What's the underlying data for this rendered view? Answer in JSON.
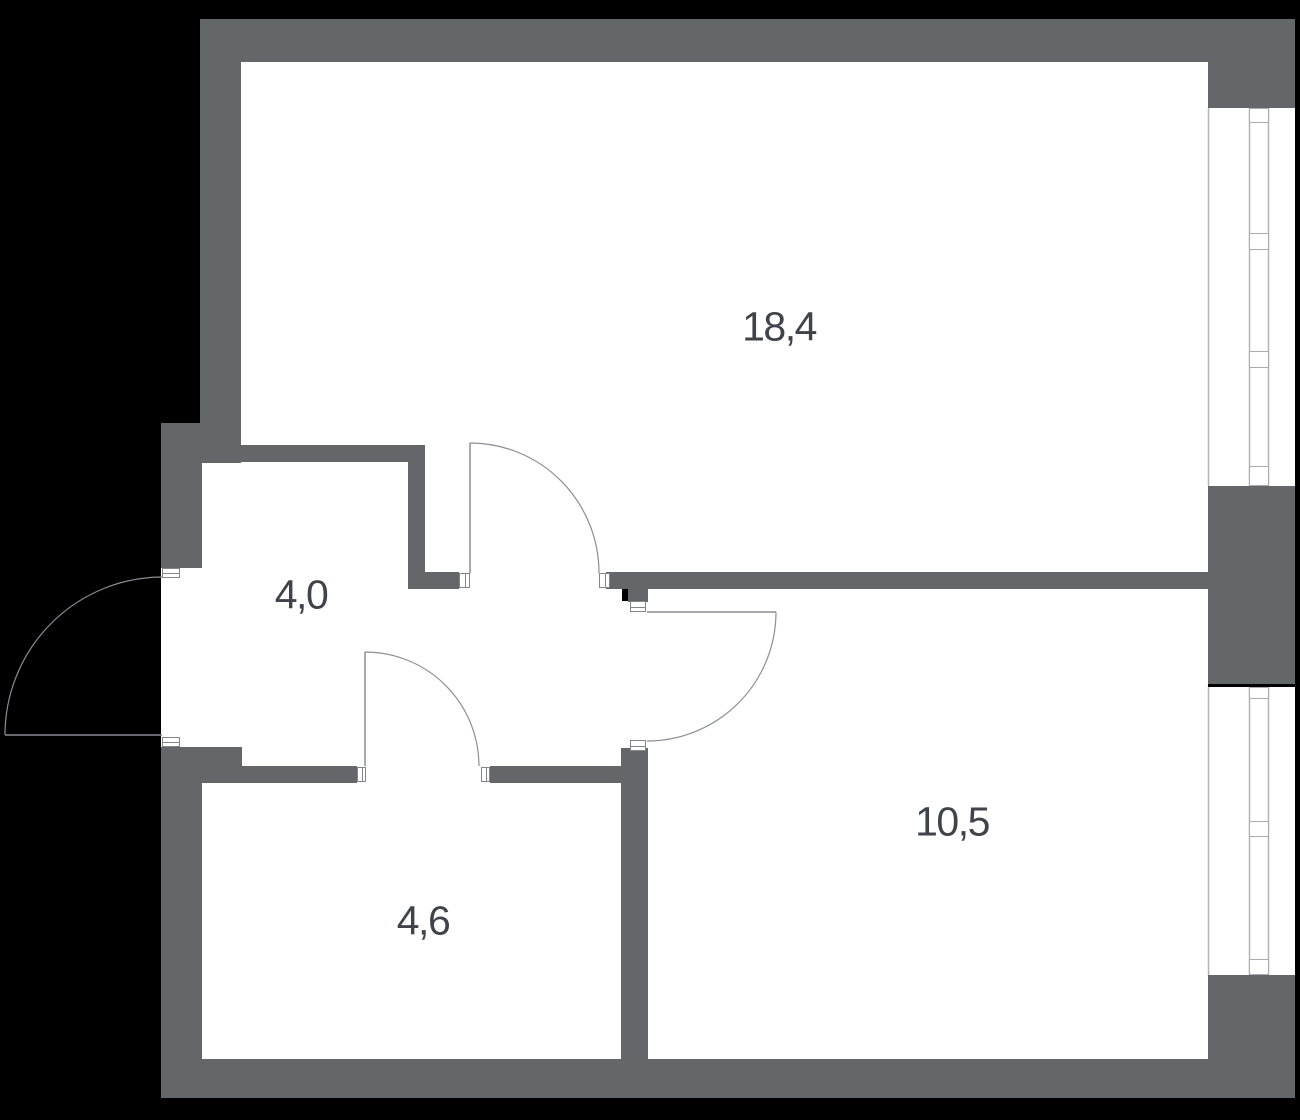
{
  "plan": {
    "background_color": "#000000",
    "floor_color": "#ffffff",
    "wall_color": "#64676a",
    "thin_line_color": "#8c8e96",
    "window_line_color": "#b2b4bd",
    "jamb_border_color": "#83858b",
    "label_color": "#3f444b",
    "rooms": [
      {
        "id": "room-18-4",
        "area": "18,4",
        "label_x": 779,
        "label_y": 327
      },
      {
        "id": "room-4-0",
        "area": "4,0",
        "label_x": 301,
        "label_y": 595
      },
      {
        "id": "room-4-6",
        "area": "4,6",
        "label_x": 423,
        "label_y": 921
      },
      {
        "id": "room-10-5",
        "area": "10,5",
        "label_x": 952,
        "label_y": 822
      }
    ],
    "floor_rects": [
      [
        241,
        62,
        967,
        511
      ],
      [
        200,
        463,
        208,
        303
      ],
      [
        408,
        589,
        214,
        177
      ],
      [
        459,
        573,
        151,
        16
      ],
      [
        622,
        601,
        26,
        152
      ],
      [
        357,
        766,
        133,
        17
      ],
      [
        161,
        568,
        41,
        179
      ],
      [
        202,
        783,
        420,
        276
      ],
      [
        648,
        589,
        560,
        470
      ],
      [
        1208,
        108,
        87,
        378
      ],
      [
        1208,
        687,
        87,
        288
      ]
    ],
    "walls": [
      [
        200,
        19,
        1095,
        43
      ],
      [
        1208,
        62,
        87,
        46
      ],
      [
        1208,
        486,
        87,
        198
      ],
      [
        1208,
        975,
        87,
        123
      ],
      [
        161,
        1059,
        1047,
        39
      ],
      [
        200,
        19,
        41,
        444
      ],
      [
        200,
        445,
        223,
        17
      ],
      [
        408,
        445,
        17,
        127
      ],
      [
        408,
        572,
        51,
        17
      ],
      [
        606,
        572,
        602,
        17
      ],
      [
        628,
        589,
        20,
        13
      ],
      [
        621,
        748,
        27,
        311
      ],
      [
        202,
        766,
        155,
        17
      ],
      [
        202,
        747,
        40,
        19
      ],
      [
        490,
        766,
        132,
        17
      ],
      [
        161,
        423,
        41,
        145
      ],
      [
        161,
        747,
        41,
        312
      ]
    ],
    "door_jambs": [
      {
        "x": 162,
        "y": 568,
        "w": 18,
        "h": 10,
        "o": "h"
      },
      {
        "x": 162,
        "y": 737,
        "w": 18,
        "h": 10,
        "o": "h"
      },
      {
        "x": 459,
        "y": 573,
        "w": 11,
        "h": 15,
        "o": "v"
      },
      {
        "x": 599,
        "y": 573,
        "w": 11,
        "h": 15,
        "o": "v"
      },
      {
        "x": 630,
        "y": 601,
        "w": 16,
        "h": 11,
        "o": "h"
      },
      {
        "x": 630,
        "y": 740,
        "w": 16,
        "h": 11,
        "o": "h"
      },
      {
        "x": 357,
        "y": 767,
        "w": 9,
        "h": 15,
        "o": "v"
      },
      {
        "x": 481,
        "y": 767,
        "w": 9,
        "h": 15,
        "o": "v"
      }
    ],
    "door_leaves": [
      [
        5,
        735,
        162,
        735
      ],
      [
        470,
        443,
        470,
        573
      ],
      [
        647,
        612,
        776,
        612
      ],
      [
        365,
        652,
        365,
        766
      ]
    ],
    "door_arcs": [
      "M 5 735 A 158 158 0 0 1 162 577",
      "M 470 443 A 129 130 0 0 1 599 573",
      "M 776 612 A 129 129 0 0 1 647 741",
      "M 365 652 A 114 114 0 0 1 479 766"
    ],
    "window_lines": [
      [
        1208.5,
        108,
        1208.5,
        486
      ],
      [
        1249.5,
        108,
        1249.5,
        486
      ],
      [
        1268.5,
        108,
        1268.5,
        486
      ],
      [
        1208.5,
        687,
        1208.5,
        975
      ],
      [
        1249.5,
        687,
        1249.5,
        975
      ],
      [
        1268.5,
        687,
        1268.5,
        975
      ]
    ],
    "window_transoms": [
      [
        1249,
        108,
        20,
        15
      ],
      [
        1249,
        233,
        20,
        17
      ],
      [
        1249,
        351,
        20,
        17
      ],
      [
        1249,
        466,
        20,
        20
      ],
      [
        1249,
        687,
        20,
        12
      ],
      [
        1249,
        821,
        20,
        16
      ],
      [
        1249,
        959,
        20,
        16
      ]
    ]
  }
}
